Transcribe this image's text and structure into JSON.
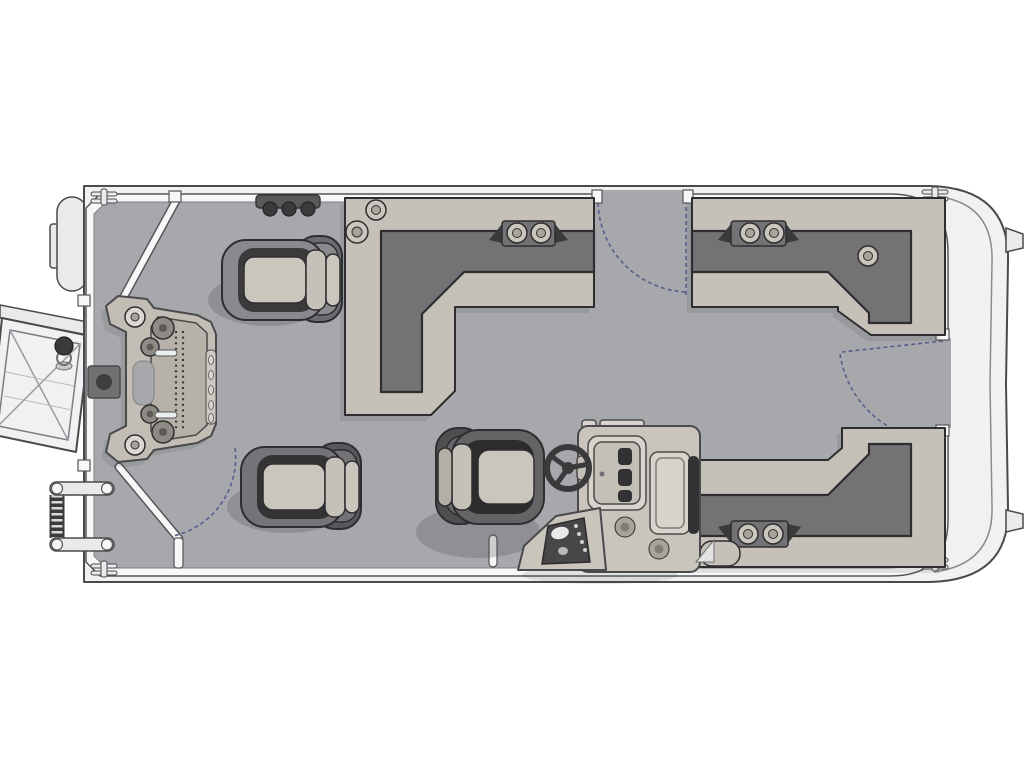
{
  "diagram": {
    "label": "Pontoon boat floor plan, top view with bow at left",
    "type": "boat-floorplan",
    "orientation": "bow-left-stern-right"
  },
  "features": [
    "bow-boarding-platform",
    "boarding-ladder",
    "bow-nose-cone",
    "bow-gate-console-with-cup-holders",
    "pedestal-mount-plate",
    "port-forward-captain-chair",
    "port-aft-captain-chair",
    "bow-l-lounge",
    "port-stern-l-lounge",
    "starboard-stern-l-lounge",
    "cup-holder-plates",
    "helm-console",
    "steering-wheel",
    "instrument-cluster",
    "throttle-control-panel",
    "helm-captain-chair",
    "side-gate-swing-arc",
    "port-gate-swing-arc",
    "stern-gate-swing-arc",
    "mooring-cleats",
    "stern-platform",
    "engine-mount-tabs",
    "bow-rail-diagonals"
  ],
  "palette": {
    "bg": "#ffffff",
    "hull": "#f0f1f2",
    "hullLine": "#4a4a4c",
    "band": "#f7f7f8",
    "bandLine": "#55565a",
    "deck": "#a7a8ab",
    "deckLine": "#7f8083",
    "benchBack": "#c6c1b8",
    "benchSeat": "#737376",
    "benchLine": "#2e2e30",
    "cushion": "#cbc6bd",
    "cushionMid": "#a9a49b",
    "chairShell": "#8a8a8e",
    "chairShellDark": "#646467",
    "chairBand": "#6b6b6f",
    "chairInner": "#3b3b3d",
    "consoleBody": "#c9c5bd",
    "consoleTrim": "#d8d4cc",
    "panelDark": "#47474a",
    "slotDark": "#323234",
    "knobDark": "#3a3a3c",
    "arc": "#5b5b8e",
    "shadow": "#3c3c40",
    "metal": "#e9eaeb"
  }
}
